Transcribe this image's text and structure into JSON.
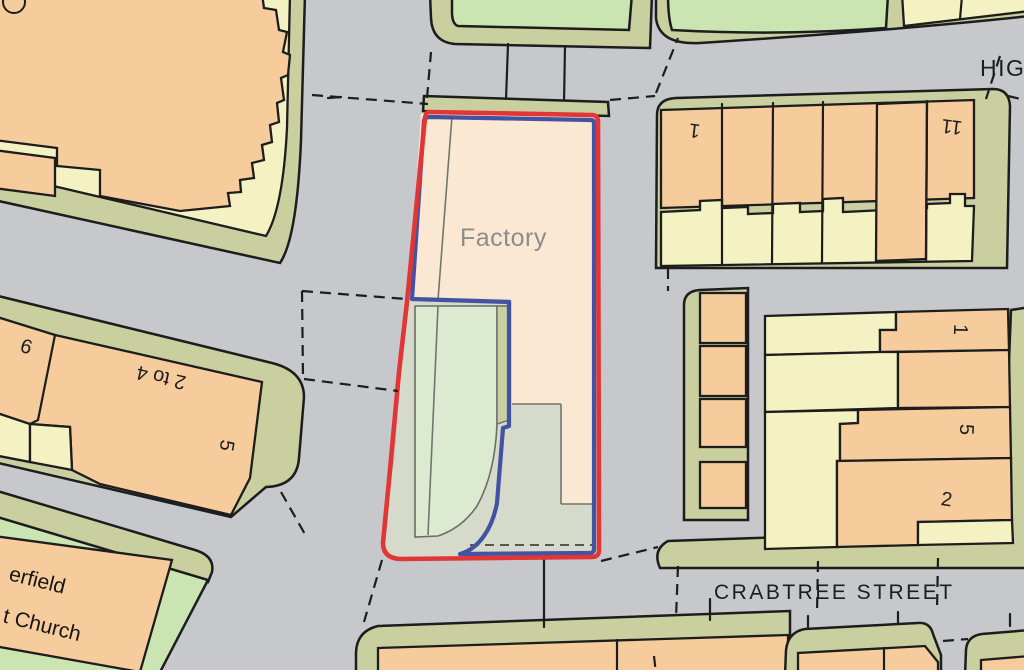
{
  "map": {
    "type": "os-style-site-location-plan",
    "labels": {
      "factory": "Factory",
      "street_crabtree": "CRABTREE STREET",
      "street_high_partial": "HIG",
      "num_9": "9",
      "num_2_to_4": "2 to 4",
      "num_5_left": "5",
      "church_line1": "erfield",
      "church_line2": "t Church",
      "num_1_terrace": "1",
      "num_11": "11",
      "num_1_right": "1",
      "num_5_right": "5",
      "num_2_right": "2"
    },
    "colors": {
      "road_gray": "#c7c8cb",
      "building_orange": "#f7cc9d",
      "building_pale_yellow": "#f4f2c2",
      "verge_olive": "#cacfa0",
      "grass_green": "#cbe5b2",
      "site_parcel_green": "#dcead0",
      "site_sage": "#d6dacb",
      "factory_peach": "#fbe8d2",
      "outline_black": "#1d1d1d",
      "boundary_red": "#e23535",
      "boundary_blue": "#4353a4",
      "factory_label_gray": "#8c8c8c"
    }
  }
}
